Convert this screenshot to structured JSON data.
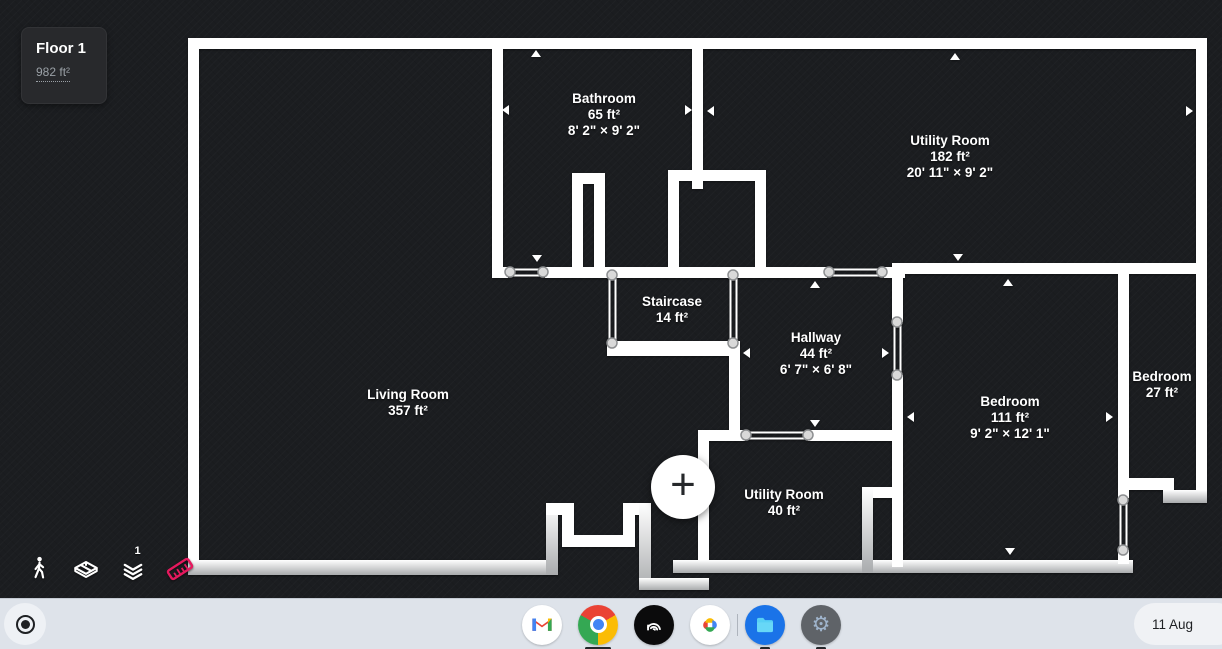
{
  "app": {
    "floor_card": {
      "title": "Floor 1",
      "area": "982 ft²"
    },
    "rooms": [
      {
        "name": "Bathroom",
        "area": "65 ft²",
        "dims": "8' 2\" × 9' 2\"",
        "x": 604,
        "y": 115
      },
      {
        "name": "Utility Room",
        "area": "182 ft²",
        "dims": "20' 11\" × 9' 2\"",
        "x": 950,
        "y": 157
      },
      {
        "name": "Staircase",
        "area": "14 ft²",
        "dims": "",
        "x": 672,
        "y": 310
      },
      {
        "name": "Hallway",
        "area": "44 ft²",
        "dims": "6' 7\" × 6' 8\"",
        "x": 816,
        "y": 354
      },
      {
        "name": "Living Room",
        "area": "357 ft²",
        "dims": "",
        "x": 408,
        "y": 403
      },
      {
        "name": "Bedroom",
        "area": "111 ft²",
        "dims": "9' 2\" × 12' 1\"",
        "x": 1010,
        "y": 418
      },
      {
        "name": "Bedroom",
        "area": "27 ft²",
        "dims": "",
        "x": 1162,
        "y": 385
      },
      {
        "name": "Utility Room",
        "area": "40 ft²",
        "dims": "",
        "x": 784,
        "y": 503
      }
    ],
    "toolbar": {
      "layers_badge": "1",
      "icons": [
        "walk-mode",
        "3d-view",
        "layers",
        "ruler"
      ]
    },
    "add_button": {
      "symbol": "+"
    },
    "colors": {
      "canvas_bg": "#1b1d20",
      "wall": "#ffffff",
      "ruler_accent": "#e5195e"
    }
  },
  "shelf": {
    "launcher": "app-launcher",
    "apps": [
      {
        "name": "gmail"
      },
      {
        "name": "chrome",
        "indicator": "active"
      },
      {
        "name": "floorplan-app"
      },
      {
        "name": "google-photos"
      },
      {
        "name": "files",
        "indicator": "open"
      },
      {
        "name": "settings",
        "indicator": "open"
      }
    ],
    "status": {
      "date": "11 Aug"
    }
  }
}
